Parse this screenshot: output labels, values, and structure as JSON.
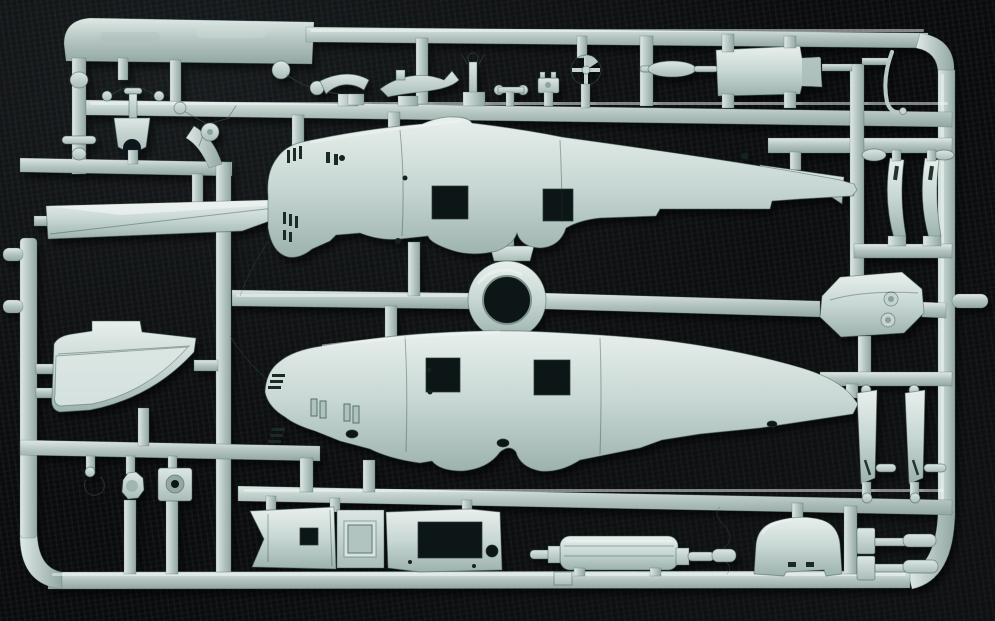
{
  "scene": {
    "kind": "photograph",
    "subject": "Injection-molded plastic model kit sprue of grey-green styrene aircraft parts, photographed on black woven fabric",
    "lighting": "single soft light from upper left, parts cast small dark shadows down-right",
    "marking": "faint illegible embossed lettering on the wide top-left runner tab"
  },
  "palette": {
    "background": "#0a0b0c",
    "plastic_light": "#dfe9e6",
    "plastic": "#b7c7c3",
    "plastic_shadow": "#92a7a2",
    "plastic_deep": "#6f847f",
    "fuselage_light": "#e8efec",
    "fuselage_mid": "#c7d7d3",
    "fuselage_shadow": "#9db2ad",
    "hole_dark": "#0e1413"
  },
  "sprue": {
    "frame": "rounded rectangular outer runner frame with wide flat label tab at top-left and internal runner lattice",
    "parts": [
      {
        "id": "fuselage-half-upper",
        "desc": "large fuselage half, nose to the left, two square window cutouts, cowl gill slits on nose, tapering tail"
      },
      {
        "id": "fuselage-half-lower",
        "desc": "matching opposite fuselage half, nose to the left, two square cutouts, gill slits, recessed hatches"
      },
      {
        "id": "cowl-ring",
        "desc": "circular ring part at sprue center"
      },
      {
        "id": "ring-bracket",
        "desc": "small trapezoid bracket above the ring"
      },
      {
        "id": "wing-slat-strip",
        "desc": "long tapered leading-edge strip, upper left"
      },
      {
        "id": "tail-fin-flap",
        "desc": "tail fin with curved overlapping flap, mid left"
      },
      {
        "id": "antenna-mast",
        "desc": "thin vertical rod with ball top and crossbar, far upper left"
      },
      {
        "id": "engine-mount-bracket",
        "desc": "candelabra-shaped mount with arched base, upper left"
      },
      {
        "id": "landing-gear-cluster",
        "desc": "small bent-leg gear cluster with tiny wheel disc"
      },
      {
        "id": "ball-rod-lever",
        "desc": "bent lever with ball end, top parts row"
      },
      {
        "id": "control-horn-left",
        "desc": "curved control horn blade with disc end, top parts row"
      },
      {
        "id": "control-horn-right",
        "desc": "swept horn blade with upturned tip, top parts row"
      },
      {
        "id": "valve-fitting",
        "desc": "small forked valve stem, top parts row"
      },
      {
        "id": "tee-fitting",
        "desc": "small tee with rounded ends, top parts row"
      },
      {
        "id": "clamp-block",
        "desc": "tiny toothed clamp block, top parts row"
      },
      {
        "id": "control-wheel",
        "desc": "spoked control wheel on pedestal, top parts row"
      },
      {
        "id": "bulkhead-plate",
        "desc": "rectangular bulkhead plate with stepped right edge, top right"
      },
      {
        "id": "push-rod",
        "desc": "thin rod with elongated bulge, left of bulkhead plate"
      },
      {
        "id": "wire-antenna",
        "desc": "thin bent wire antenna, far top right"
      },
      {
        "id": "tailplane-strip",
        "desc": "angled flat strip, right of upper fuselage tail"
      },
      {
        "id": "door-blade-left",
        "desc": "curved vertical door strip with slot, upper right"
      },
      {
        "id": "door-blade-right",
        "desc": "second curved vertical door strip with slot, upper right"
      },
      {
        "id": "gearbox-cover",
        "desc": "elongated octagonal cover with two round bosses, mid right"
      },
      {
        "id": "strut-strip-left",
        "desc": "flat vertical strut strip with slash slot, lower right"
      },
      {
        "id": "strut-strip-right",
        "desc": "second flat vertical strut strip, lower right"
      },
      {
        "id": "hook-part",
        "desc": "small hook, lower left parts row"
      },
      {
        "id": "wheel-disc",
        "desc": "small octagonal wheel disc, lower left parts row"
      },
      {
        "id": "keyed-plate",
        "desc": "small square plate with round hole, lower left parts row"
      },
      {
        "id": "cockpit-floor",
        "desc": "floor plank with chevron end and rectangular opening, bottom center"
      },
      {
        "id": "center-console",
        "desc": "raised console box with recessed top, bottom center"
      },
      {
        "id": "cabin-panel",
        "desc": "flat panel with large rectangular cutout and round hole, bottom center"
      },
      {
        "id": "engine-cylinder-block",
        "desc": "ribbed cylinder block with shafts both ends, bottom center-right"
      },
      {
        "id": "rudder-fin",
        "desc": "round-topped rudder with notched base, bottom right"
      },
      {
        "id": "external-tank-upper",
        "desc": "small cylinder with block mount, far bottom right"
      },
      {
        "id": "external-tank-lower",
        "desc": "second small cylinder with block mount, far bottom right"
      }
    ]
  }
}
